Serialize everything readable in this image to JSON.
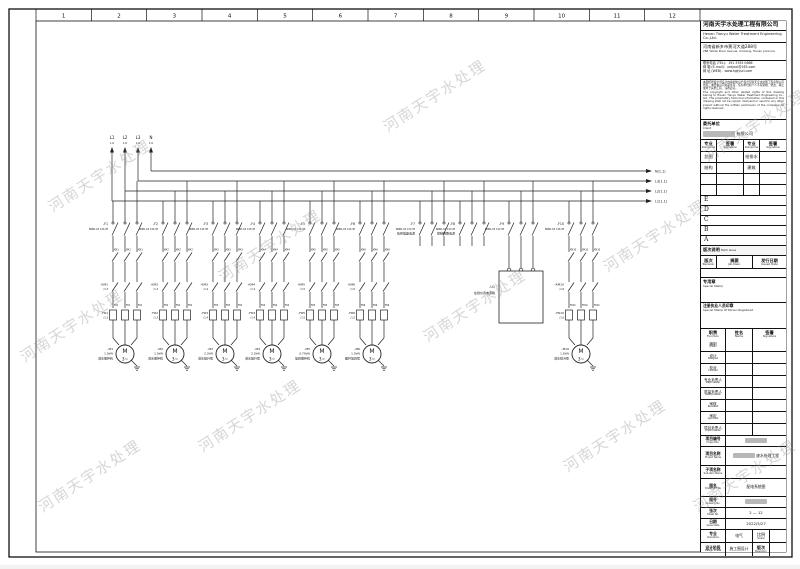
{
  "watermark": {
    "text": "河南天宇水处理"
  },
  "frame": {
    "columns": [
      "1",
      "2",
      "3",
      "4",
      "5",
      "6",
      "7",
      "8",
      "9",
      "10",
      "11",
      "12"
    ]
  },
  "company": {
    "name_cn": "河南天宇水处理工程有限公司",
    "name_en": "Henan Tianyu Water Treatment Engineering Co.,Ltd.",
    "addr_cn": "河南省新乡市黄河大道288号",
    "addr_en": "288 Yellow River Avenue, Xinxiang, Henan province",
    "tel_label": "联系电话 (TEL)：",
    "tel": "191 3355 0686",
    "email_label": "邮  箱 (E-mail)：",
    "email": "xxtyscl@163.com",
    "web_label": "网  址 (WEB)：",
    "web": "www.hgtyscl.com",
    "notice_cn": "本图纸所载全部设计内容的知识产权归河南天宇水处理工程有限公司所有。未经本公司书面许可，任何单位和个人不得复制、修改、转让或用于其他工程，违者必究。",
    "notice_en": "The copyright and other related rights of this drawing belong to Henan Tianyu Water Treatment Engineering Co., Ltd. The proprietary technical information contained in this drawing shall not be copied, disclosed or used for any other project without the written permission of the company. All rights reserved."
  },
  "title_block": {
    "client": {
      "label_cn": "委托单位",
      "label_en": "Client",
      "value_suffix": "有限公司"
    },
    "sign_grid": {
      "h1_cn": "专业",
      "h1_en": "Discipline",
      "h2_cn": "签署",
      "h2_en": "Signature",
      "h3_cn": "专业",
      "h3_en": "Discipline",
      "h4_cn": "签署",
      "h4_en": "Signature",
      "r1c1": "总图",
      "r1c3": "给排水",
      "r2c1": "结构",
      "r2c3": "建筑"
    },
    "revision_letters": [
      "E",
      "D",
      "C",
      "B",
      "A"
    ],
    "mark_issue_cn": "版次说明",
    "mark_issue_en": "Mark Issue",
    "rev_h1_cn": "版次",
    "rev_h1_en": "Revision",
    "rev_h2_cn": "摘要",
    "rev_h2_en": "Job Desc.",
    "rev_h3_cn": "发行日期",
    "rev_h3_en": "Issued Date",
    "special_stamp_cn": "专用章",
    "special_stamp_en": "Special Stamp",
    "registered_stamp_cn": "注册执业人员印章",
    "registered_stamp_en": "Special Stamp Of Person Registered",
    "function_table": {
      "h1_cn": "职责",
      "h1_en": "Function",
      "h2_cn": "姓名",
      "h2_en": "Name",
      "h3_cn": "签署",
      "h3_en": "Signature",
      "rows_cn": [
        "编制",
        "设计",
        "校对",
        "专业负责人",
        "质量负责人",
        "审核",
        "审定",
        "项目负责人"
      ],
      "rows_en": [
        "Drawn",
        "Designed",
        "Checked",
        "Major Leader",
        "Quality Leader",
        "Reviewed",
        "Approved",
        "Project Leader"
      ]
    },
    "info": {
      "project_no_cn": "项目编号",
      "project_no_en": "Project No.",
      "project_name_cn": "项目名称",
      "project_name_en": "Project Name",
      "project_name_value": "废水处理工程",
      "subitem_cn": "子项名称",
      "subitem_en": "Sub-item Name",
      "subitem_value": "",
      "title_cn": "图名",
      "title_en": "Drawing Title",
      "title_value": "配电系统图",
      "drawing_no_cn": "图号",
      "drawing_no_en": "Drawing No.",
      "sheet_cn": "张次",
      "sheet_en": "Sheet No.",
      "sheet_value": "2 — 12",
      "date_cn": "日期",
      "date_en": "Issue Date",
      "date_value": "2022/5/27",
      "discipline_cn": "专业",
      "discipline_en": "Discipline",
      "discipline_value": "电气",
      "scale_cn": "比例",
      "scale_en": "Scale",
      "scale_value": "",
      "phase_cn": "设计阶段",
      "phase_en": "Design Phase",
      "phase_value": "施工图设计",
      "revision_cn": "版次",
      "revision_en": "Revision",
      "revision_value": ""
    }
  },
  "diagram": {
    "incoming": {
      "labels": [
        "L1",
        "L2",
        "L3",
        "N"
      ],
      "ref": "1.0"
    },
    "bus_out": [
      "N(1.1)",
      "L3(1.1)",
      "L2(1.1)",
      "L1(1.1)"
    ],
    "motor_symbol": {
      "letter": "M",
      "phase": "3~"
    },
    "branches": [
      {
        "type": "motor",
        "tag": "-F1",
        "spec": "NDB1-63 C16 3P",
        "km": "KM1",
        "km_tag": "-KM1",
        "km_ref": "/1.3",
        "fr": "FR1",
        "fr_tag": "-FR1",
        "fr_ref": "/1.3",
        "motor": "-M1",
        "power": "1.5kW",
        "name": "潜水搅拌机"
      },
      {
        "type": "motor",
        "tag": "-F2",
        "spec": "NDB1-63 C16 3P",
        "km": "KM2",
        "km_tag": "-KM2",
        "km_ref": "/1.3",
        "fr": "FR2",
        "fr_tag": "-FR2",
        "fr_ref": "/1.3",
        "motor": "-M2",
        "power": "1.5kW",
        "name": "潜水搅拌机"
      },
      {
        "type": "motor",
        "tag": "-F3",
        "spec": "NDB1-63 C16 3P",
        "km": "KM3",
        "km_tag": "-KM3",
        "km_ref": "/1.4",
        "fr": "FR3",
        "fr_tag": "-FR3",
        "fr_ref": "/1.4",
        "motor": "-M3",
        "power": "2.2kW",
        "name": "潜水提升泵"
      },
      {
        "type": "motor",
        "tag": "-F4",
        "spec": "NDB1-63 C16 3P",
        "km": "KM4",
        "km_tag": "-KM4",
        "km_ref": "/1.4",
        "fr": "FR4",
        "fr_tag": "-FR4",
        "fr_ref": "/1.4",
        "motor": "-M4",
        "power": "2.2kW",
        "name": "潜水提升泵"
      },
      {
        "type": "motor",
        "tag": "-F5",
        "spec": "NDB1-63 C16 3P",
        "km": "KM5",
        "km_tag": "-KM5",
        "km_ref": "/1.5",
        "fr": "FR5",
        "fr_tag": "-FR5",
        "fr_ref": "/1.5",
        "motor": "-M5",
        "power": "0.75kW",
        "name": "加药搅拌机"
      },
      {
        "type": "motor",
        "tag": "-F6",
        "spec": "NDB1-63 C16 3P",
        "km": "KM6",
        "km_tag": "-KM6",
        "km_ref": "/1.5",
        "fr": "FR6",
        "fr_tag": "-FR6",
        "fr_ref": "/1.5",
        "motor": "-M6",
        "power": "1.5kW",
        "name": "螺杆加药泵"
      },
      {
        "type": "stub",
        "tag": "-F7",
        "spec": "NDB1-63 C10 3P",
        "name": "检修插座电源"
      },
      {
        "type": "stub",
        "tag": "-F8",
        "spec": "NDB1-63 C10 3P",
        "name": "控制回路电源"
      },
      {
        "type": "box",
        "tag": "-F9",
        "spec": "NDB1-63 C10 3P",
        "box_tag": "-U1",
        "box_name": "在线仪表电源箱"
      },
      {
        "type": "motor",
        "tag": "-F10",
        "spec": "NDB1-63 C16 3P",
        "km": "KM10",
        "km_tag": "-KM10",
        "km_ref": "/1.6",
        "fr": "FR10",
        "fr_tag": "-FR10",
        "fr_ref": "/1.6",
        "motor": "-M10",
        "power": "1.5kW",
        "name": "潜水排污泵"
      }
    ]
  }
}
